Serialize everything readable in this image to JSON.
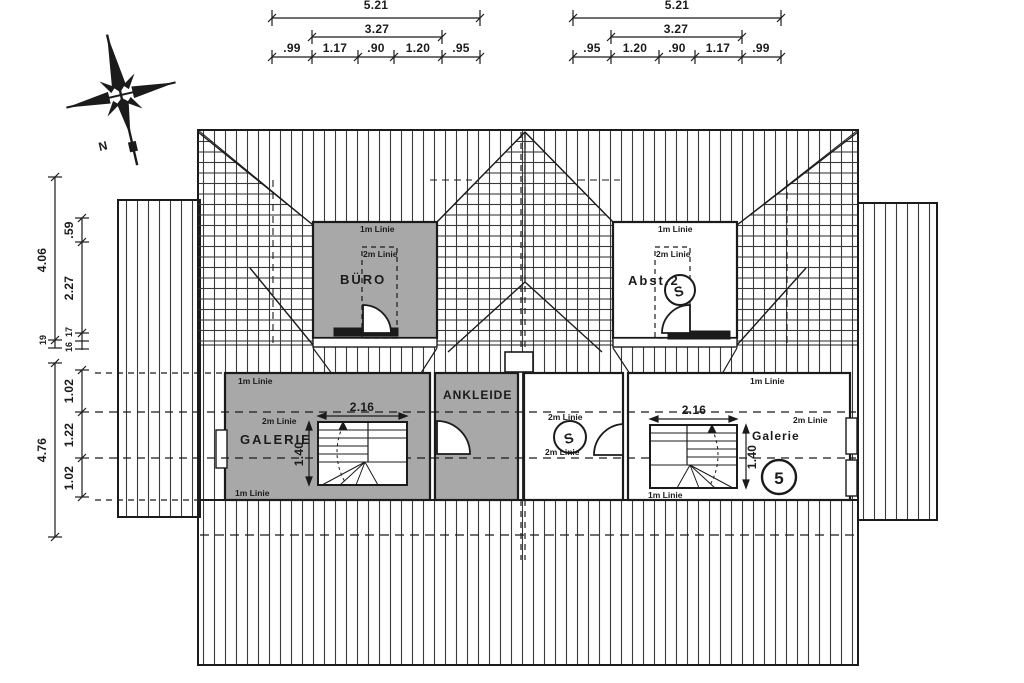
{
  "compass": {
    "north": "N"
  },
  "dims": {
    "top_left": {
      "total": "5.21",
      "inner": "3.27",
      "seg": [
        ".99",
        "1.17",
        ".90",
        "1.20",
        ".95"
      ]
    },
    "top_right": {
      "total": "5.21",
      "inner": "3.27",
      "seg": [
        ".95",
        "1.20",
        ".90",
        "1.17",
        ".99"
      ]
    },
    "left_upper": {
      "total": "4.06",
      "seg1": ".59",
      "seg2": "2.27",
      "s19": "19",
      "s17": "17",
      "s16": "16"
    },
    "left_lower": {
      "total": "4.76",
      "seg": [
        "1.02",
        "1.22",
        "1.02"
      ]
    }
  },
  "rooms": {
    "buero": "BÜRO",
    "abst2": "Abst.2",
    "ankleide": "ANKLEIDE",
    "galerie_left": "GALERIE",
    "galerie_right": "Galerie"
  },
  "stair": {
    "width": "2.16",
    "depth": "1.40"
  },
  "guides": {
    "m1": "1m Linie",
    "m2": "2m Linie"
  },
  "symbols": {
    "s": "S",
    "five": "5"
  },
  "colors": {
    "line": "#1b1b1b",
    "room_gray": "#a8a8a8",
    "paper": "#ffffff"
  }
}
